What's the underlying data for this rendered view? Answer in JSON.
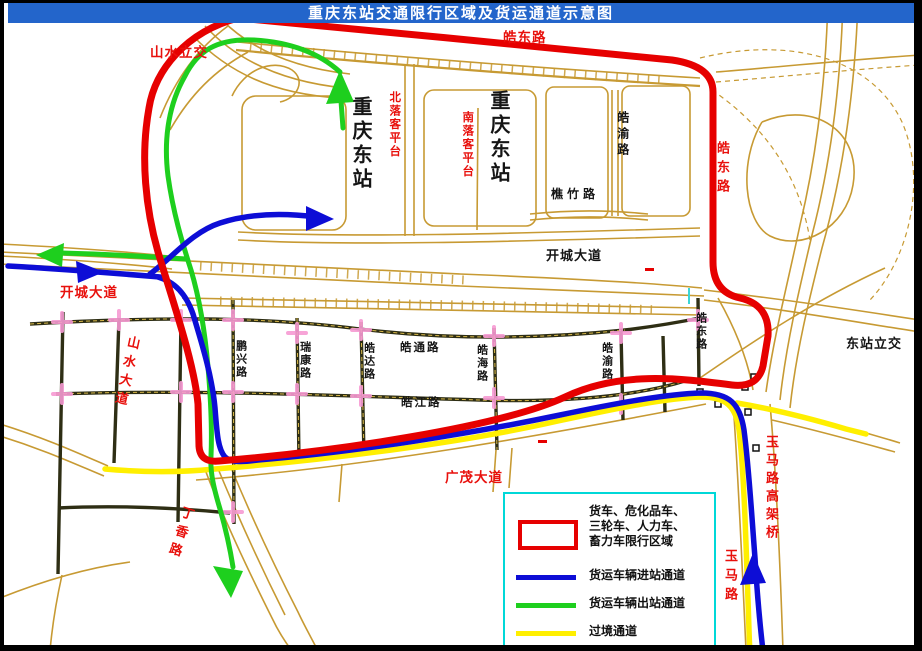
{
  "title": "重庆东站交通限行区域及货运通道示意图",
  "labels": {
    "shanshui_lijiao": "山水立交",
    "haodong_top": "皓东路",
    "cq_east_1": "重庆东站",
    "cq_east_2": "重庆东站",
    "bei_luoke": "北落客平台",
    "nan_luoke": "南落客平台",
    "haoyu_upper": "皓渝路",
    "qiaozhu": "樵竹路",
    "haodong_right": "皓东路",
    "kaicheng_center": "开城大道",
    "kaicheng_left": "开城大道",
    "shanshui_dadao": "山水大道",
    "pengxing": "鹏兴路",
    "ruikang": "瑞康路",
    "haoda": "皓达路",
    "haotong": "皓通路",
    "haohai": "皓海路",
    "haojiang": "皓江路",
    "haoyu_grid": "皓渝路",
    "haodong_grid": "皓东路",
    "dongzhan_lijiao": "东站立交",
    "guangmao": "广茂大道",
    "dingxiang": "丁香路",
    "yuma_gaojia": "玉马路高架桥",
    "yuma": "玉马路"
  },
  "legend": {
    "restricted": {
      "line1": "货车、危化品车、",
      "line2": "三轮车、人力车、",
      "line3": "畜力车限行区域"
    },
    "entry": "货运车辆进站通道",
    "exit": "货运车辆出站通道",
    "transit": "过境通道"
  },
  "colors": {
    "restricted": "#e60000",
    "entry": "#0d0dd6",
    "exit": "#1ecf1e",
    "transit": "#ffef00",
    "title_bar": "#2365cb",
    "title_text": "#ffffff",
    "legend_border": "#00d8d8",
    "road": "#c79a33",
    "label_red": "#e8100c"
  }
}
